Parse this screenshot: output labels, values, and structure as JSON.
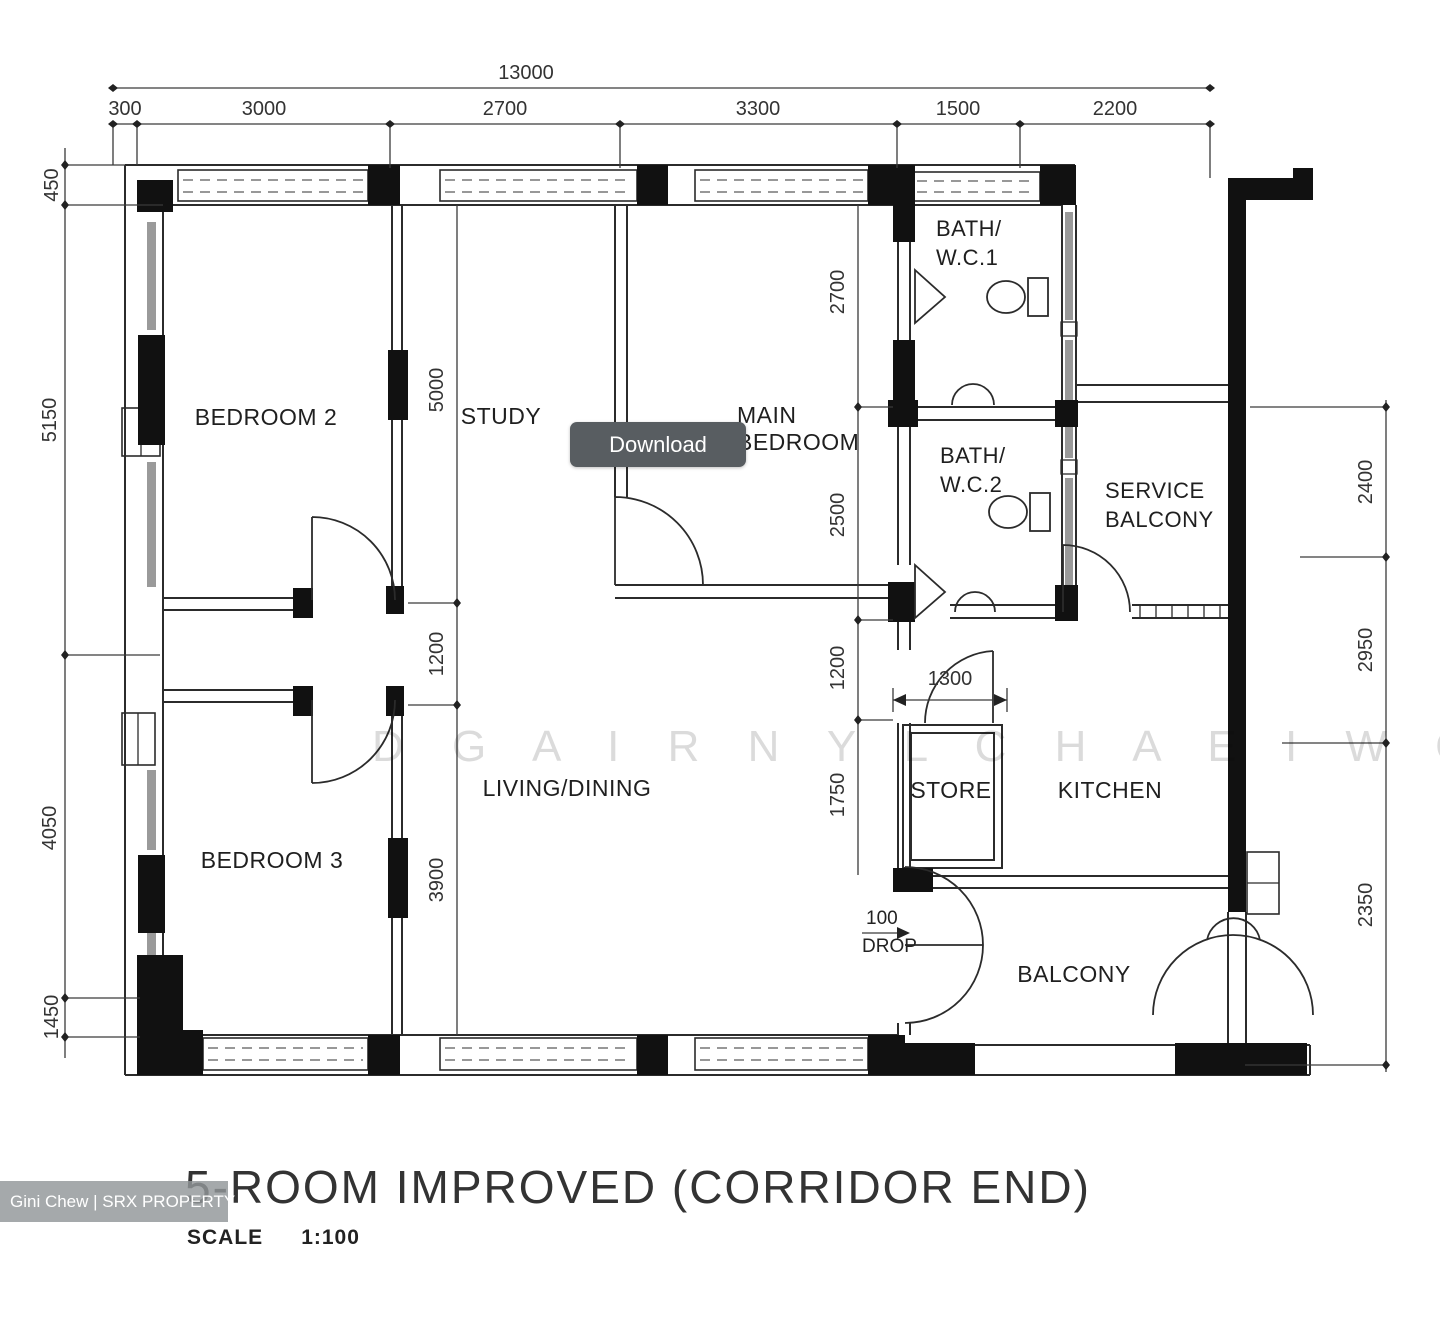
{
  "header": {
    "total_width": "13000",
    "top_segments": [
      "300",
      "3000",
      "2700",
      "3300",
      "1500",
      "2200"
    ]
  },
  "dims": {
    "left": [
      "450",
      "5150",
      "4050",
      "1450"
    ],
    "right": [
      "2400",
      "2950",
      "2350"
    ],
    "study_column": [
      "5000",
      "1200",
      "3900"
    ],
    "bedroom_column": [
      "2700",
      "2500",
      "1200",
      "1750"
    ],
    "store_opening": "1300",
    "drop_value": "100",
    "drop_label": "DROP"
  },
  "rooms": {
    "bedroom2": "BEDROOM 2",
    "study": "STUDY",
    "main_bedroom_line1": "MAIN",
    "main_bedroom_line2": "BEDROOM",
    "bath1_line1": "BATH/",
    "bath1_line2": "W.C.1",
    "bath2_line1": "BATH/",
    "bath2_line2": "W.C.2",
    "service_line1": "SERVICE",
    "service_line2": "BALCONY",
    "bedroom3": "BEDROOM 3",
    "living": "LIVING/DINING",
    "store": "STORE",
    "kitchen": "KITCHEN",
    "balcony": "BALCONY"
  },
  "title": {
    "text": "5-ROOM IMPROVED (CORRIDOR END)",
    "scale_label": "SCALE",
    "scale_value": "1:100"
  },
  "overlay": {
    "download": "Download"
  },
  "watermark": {
    "badge": "Gini Chew | SRX PROPERTY",
    "letters": "D G A I R N Y L C H A E I W G"
  },
  "colors": {
    "button": "#585d61",
    "line": "#2b2b2b",
    "badge_bg": "#919699"
  }
}
